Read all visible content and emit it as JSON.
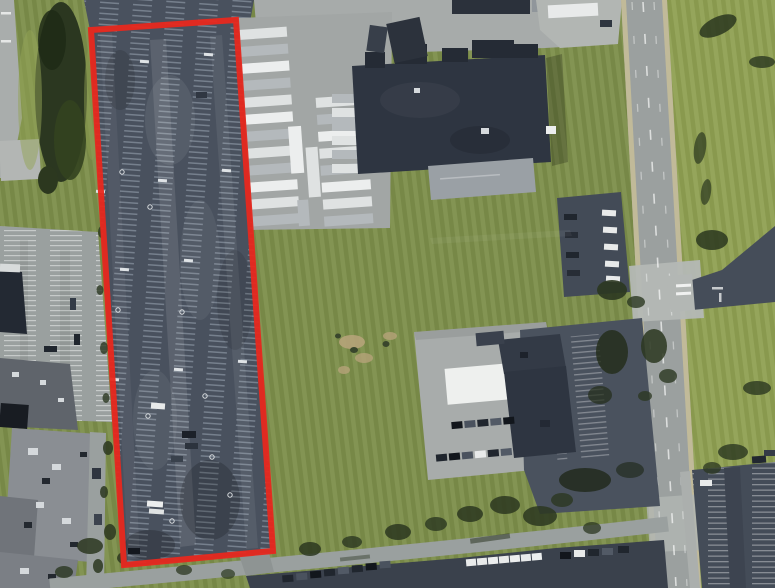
{
  "app": {
    "type": "aerial-map-viewer",
    "title": "Aerial imagery with highlighted parcel"
  },
  "map": {
    "imagery": "satellite-orthophoto",
    "scene": "Industrial and commercial area: long narrow parking-lot parcel outlined in red at left, distribution warehouse with trailer staging yard at top center, open grass fields, north-south arterial road at right, building with white and dark roof sections at lower right, gray-roof industrial buildings at lower left, car parking rows along the bottom",
    "highlight": {
      "name": "selected-parcel",
      "shape": "polygon",
      "points": "91,30 236,20 273,551 124,565",
      "stroke_color": "#e8281e",
      "stroke_width": "6",
      "fill": "none"
    },
    "palette": {
      "grass": "#7c8e4a",
      "grass_light": "#8fa052",
      "tree": "#2b3720",
      "asphalt": "#49515e",
      "asphalt_dark": "#3a414c",
      "concrete": "#a7abaa",
      "road": "#9ba09f",
      "roof_dark": "#2e3541",
      "roof_gray": "#8a8e93",
      "roof_white": "#eef0ee",
      "lane_edge": "#cbc197",
      "highlight_red": "#e8281e"
    },
    "features": [
      {
        "name": "selected-parcel-parking-lot",
        "kind": "striped parking lot",
        "highlighted": true
      },
      {
        "name": "trailer-yard",
        "kind": "truck trailer staging rows"
      },
      {
        "name": "warehouse",
        "kind": "dark flat-roof industrial building"
      },
      {
        "name": "arterial-road",
        "kind": "north-south road with lane markings"
      },
      {
        "name": "retail-building-south",
        "kind": "building with white and dark roof"
      },
      {
        "name": "industrial-buildings-west",
        "kind": "gray flat-roof buildings"
      },
      {
        "name": "grass-fields",
        "kind": "open mowed turf"
      },
      {
        "name": "parking-lot-southeast",
        "kind": "striped stalls east of road"
      },
      {
        "name": "parking-lot-south",
        "kind": "rows of parked cars"
      },
      {
        "name": "parking-lot-northeast",
        "kind": "small lot with parked cars west of road"
      }
    ]
  }
}
